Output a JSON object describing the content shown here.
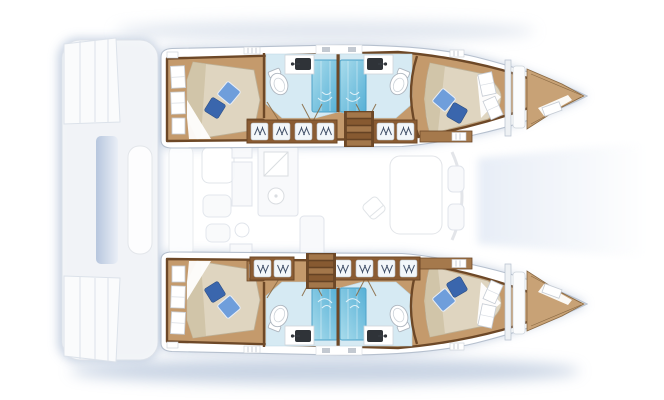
{
  "plan": {
    "vessel_type": "catamaran",
    "view": "top-down-interior-floorplan",
    "hulls": 2,
    "cabins": 4,
    "double_berths": 4,
    "pillows": 8,
    "bathrooms": 4,
    "showers": 4,
    "toilets": 4,
    "sinks": 4,
    "staircases": 2,
    "wardrobe_strips": 4,
    "transom_step_platforms": 2,
    "areas": [
      "aft-cabin-port",
      "aft-head-port",
      "forward-head-port",
      "forward-cabin-port",
      "forepeak-port",
      "aft-cabin-starboard",
      "aft-head-starboard",
      "forward-head-starboard",
      "forward-cabin-starboard",
      "forepeak-starboard",
      "salon-galley",
      "dining-table",
      "cockpit",
      "stern-platform",
      "bow-deck"
    ]
  },
  "palette": {
    "bg": "#ffffff",
    "glow": "#c3cfe0",
    "glow_deep": "#b7c6db",
    "hull_outline": "#b6c0ce",
    "hull_fill": "#ffffff",
    "wall_wood": "#6d4827",
    "floor_wood": "#c49a6c",
    "trim_wood": "#a5794c",
    "wardrobe_wood": "#8a5c33",
    "stair_light": "#a3774a",
    "stair_dark": "#875a31",
    "mattress": "#dfd5c0",
    "mattress_shade": "#cfc2a4",
    "sheet": "#ffffff",
    "pillow_light": "#6f9edb",
    "pillow_dark": "#3a66ad",
    "bath_floor": "#d6eaf3",
    "shower_light": "#a9dcec",
    "shower_deep": "#56b0d6",
    "shower_edge": "#4ea2c8",
    "porcelain": "#ffffff",
    "fixture_outline": "#aeb6bf",
    "basin_dark": "#2f3338",
    "bow_wood": "#c8a276",
    "faint_stroke": "#dde2e9",
    "faint_fill": "#f8f9fb",
    "platform_blue": "#b3c3dc",
    "vent_gray": "#c3c9d1"
  }
}
